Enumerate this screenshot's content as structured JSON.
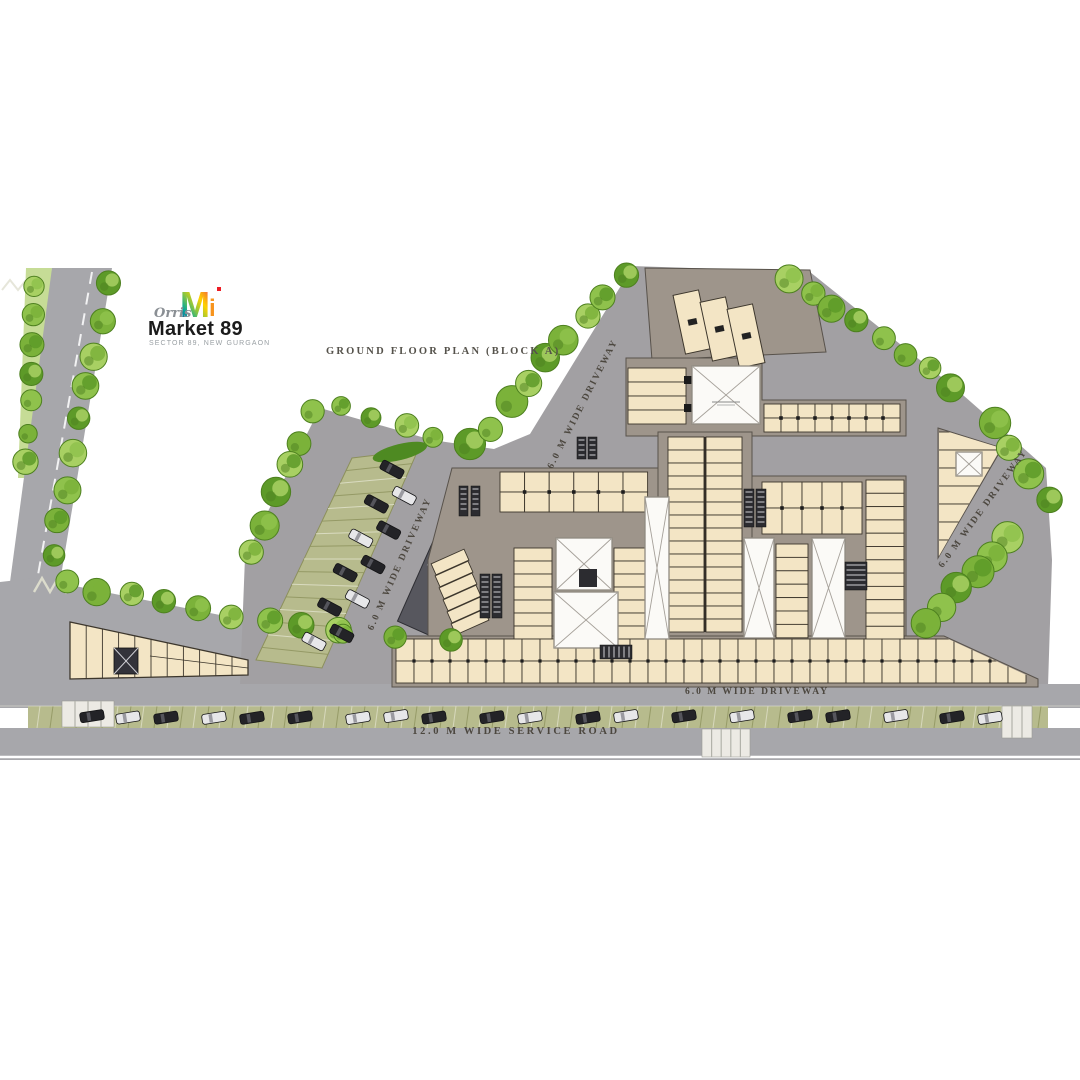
{
  "title": "GROUND FLOOR PLAN (BLOCK A)",
  "logo": {
    "script": "Orris",
    "name": "Market 89",
    "tagline": "SECTOR 89, NEW GURGAON",
    "monogram_letter": "M",
    "monogram_colors": [
      "#2e3192",
      "#00a79d",
      "#8dc63f",
      "#ffd200",
      "#f7941d",
      "#e91e8c"
    ],
    "accent_red": "#ed1c24"
  },
  "road_labels": {
    "driveway": "6.0 M WIDE DRIVEWAY",
    "service_road": "12.0 M WIDE SERVICE ROAD"
  },
  "colors": {
    "road": "#a7a7ab",
    "plaza": "#a2a0a3",
    "mall_floor": "#9e958b",
    "unit_fill": "#f3e5c5",
    "unit_stroke": "#3c362c",
    "anchor_fill": "#fbfaf7",
    "anchor_stroke": "#8f8a81",
    "anchor_x": "#a5a099",
    "tree_greens": [
      "#a8d063",
      "#8fc24c",
      "#7bb23a",
      "#5d9a28"
    ],
    "tree_dark": "#4d801f",
    "verge": "#c6dc96",
    "parking_strip": "#b7bb8d",
    "parking_hatch": "#8f945f",
    "car_dark": "#232327",
    "car_light": "#e7e7e9",
    "ramp": "#57575e",
    "escalator": "#2c2c30",
    "label_ink": "#4c473f"
  }
}
